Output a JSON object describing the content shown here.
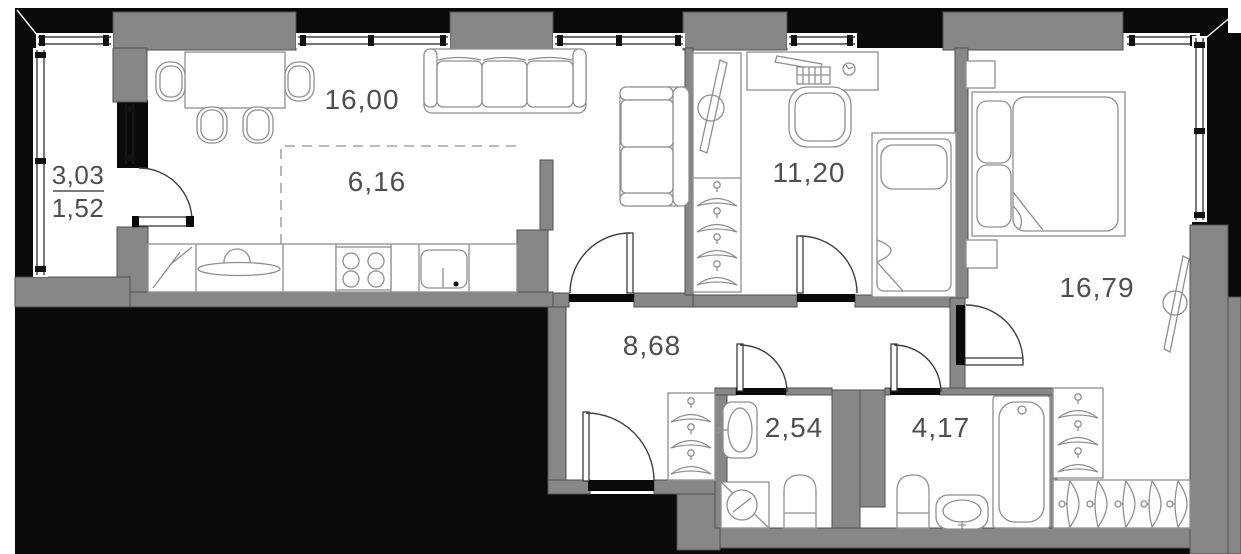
{
  "floor_plan": {
    "type": "apartment-floor-plan",
    "area_unit": "m2",
    "balcony": {
      "id": "balcony",
      "area_full": "3,03",
      "area_counted": "1,52"
    },
    "rooms": [
      {
        "id": "living-kitchen",
        "area": "16,00"
      },
      {
        "id": "kitchen-zone",
        "area": "6,16"
      },
      {
        "id": "bedroom-small",
        "area": "11,20"
      },
      {
        "id": "bedroom-master",
        "area": "16,79"
      },
      {
        "id": "hallway",
        "area": "8,68"
      },
      {
        "id": "bathroom-guest",
        "area": "2,54"
      },
      {
        "id": "bathroom-main",
        "area": "4,17"
      }
    ],
    "colors": {
      "wall_fill": "#878787",
      "exterior_fill": "#0a0a0a",
      "outline": "#4f4f4f",
      "furniture_line": "#8f8f8f",
      "label_text": "#4f4f4f",
      "background": "#ffffff"
    }
  }
}
